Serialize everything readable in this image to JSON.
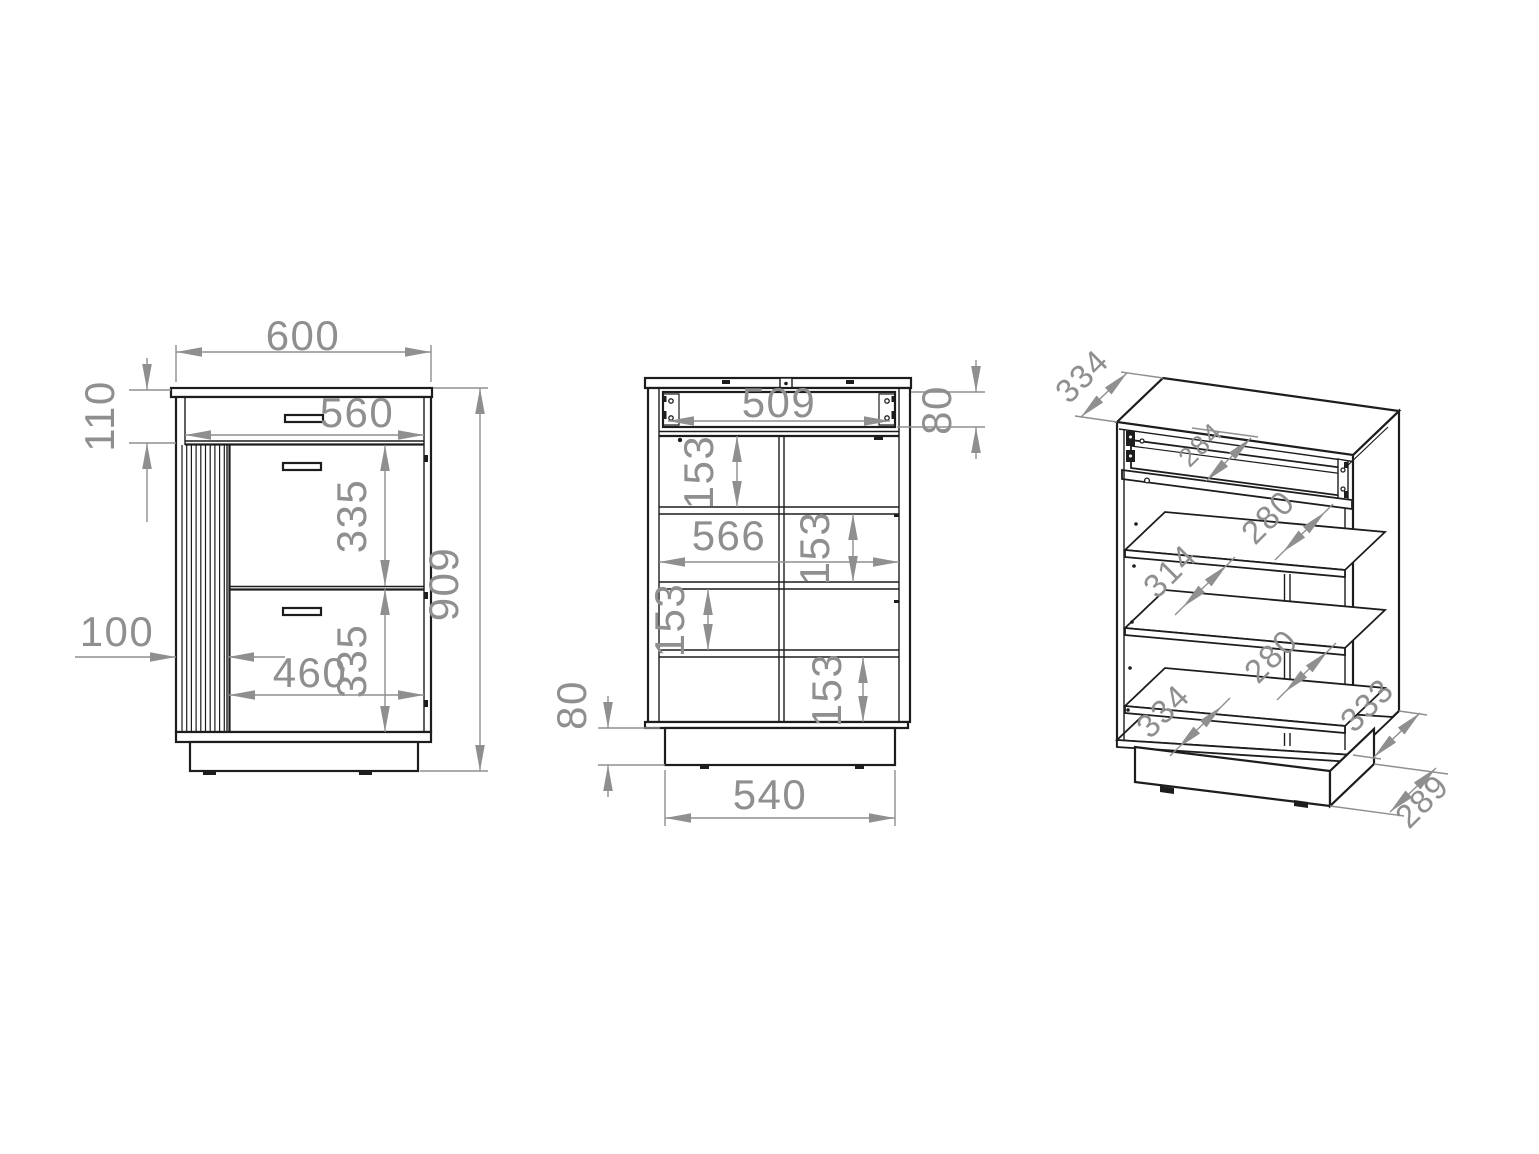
{
  "drawing": {
    "type": "furniture-technical-drawing",
    "subject": "cabinet with drawer, slatted panel and internal shelves",
    "colors": {
      "background": "#ffffff",
      "outline": "#1d1d1d",
      "dimension": "#8f8f8f"
    },
    "views": {
      "front": {
        "label": "front-elevation",
        "dims": {
          "overall_width": "600",
          "top_drawer_height": "110",
          "inner_width": "560",
          "upper_front_height": "335",
          "lower_front_height": "335",
          "overall_height": "909",
          "slat_panel_width": "100",
          "front_width": "460"
        }
      },
      "internal": {
        "label": "internal-front-view",
        "dims": {
          "drawer_inner_width": "509",
          "drawer_box_height": "80",
          "compartment_1_height": "153",
          "inner_width": "566",
          "compartment_2_height": "153",
          "compartment_3_height": "153",
          "compartment_4_height": "153",
          "plinth_height": "80",
          "plinth_width": "540"
        }
      },
      "isometric": {
        "label": "isometric-view",
        "dims": {
          "top_depth": "334",
          "drawer_depth": "284",
          "shelf_1_depth": "280",
          "shelf_2_depth": "314",
          "shelf_3_depth": "280",
          "bottom_depth": "334",
          "side_depth": "333",
          "plinth_depth": "289"
        }
      }
    }
  }
}
